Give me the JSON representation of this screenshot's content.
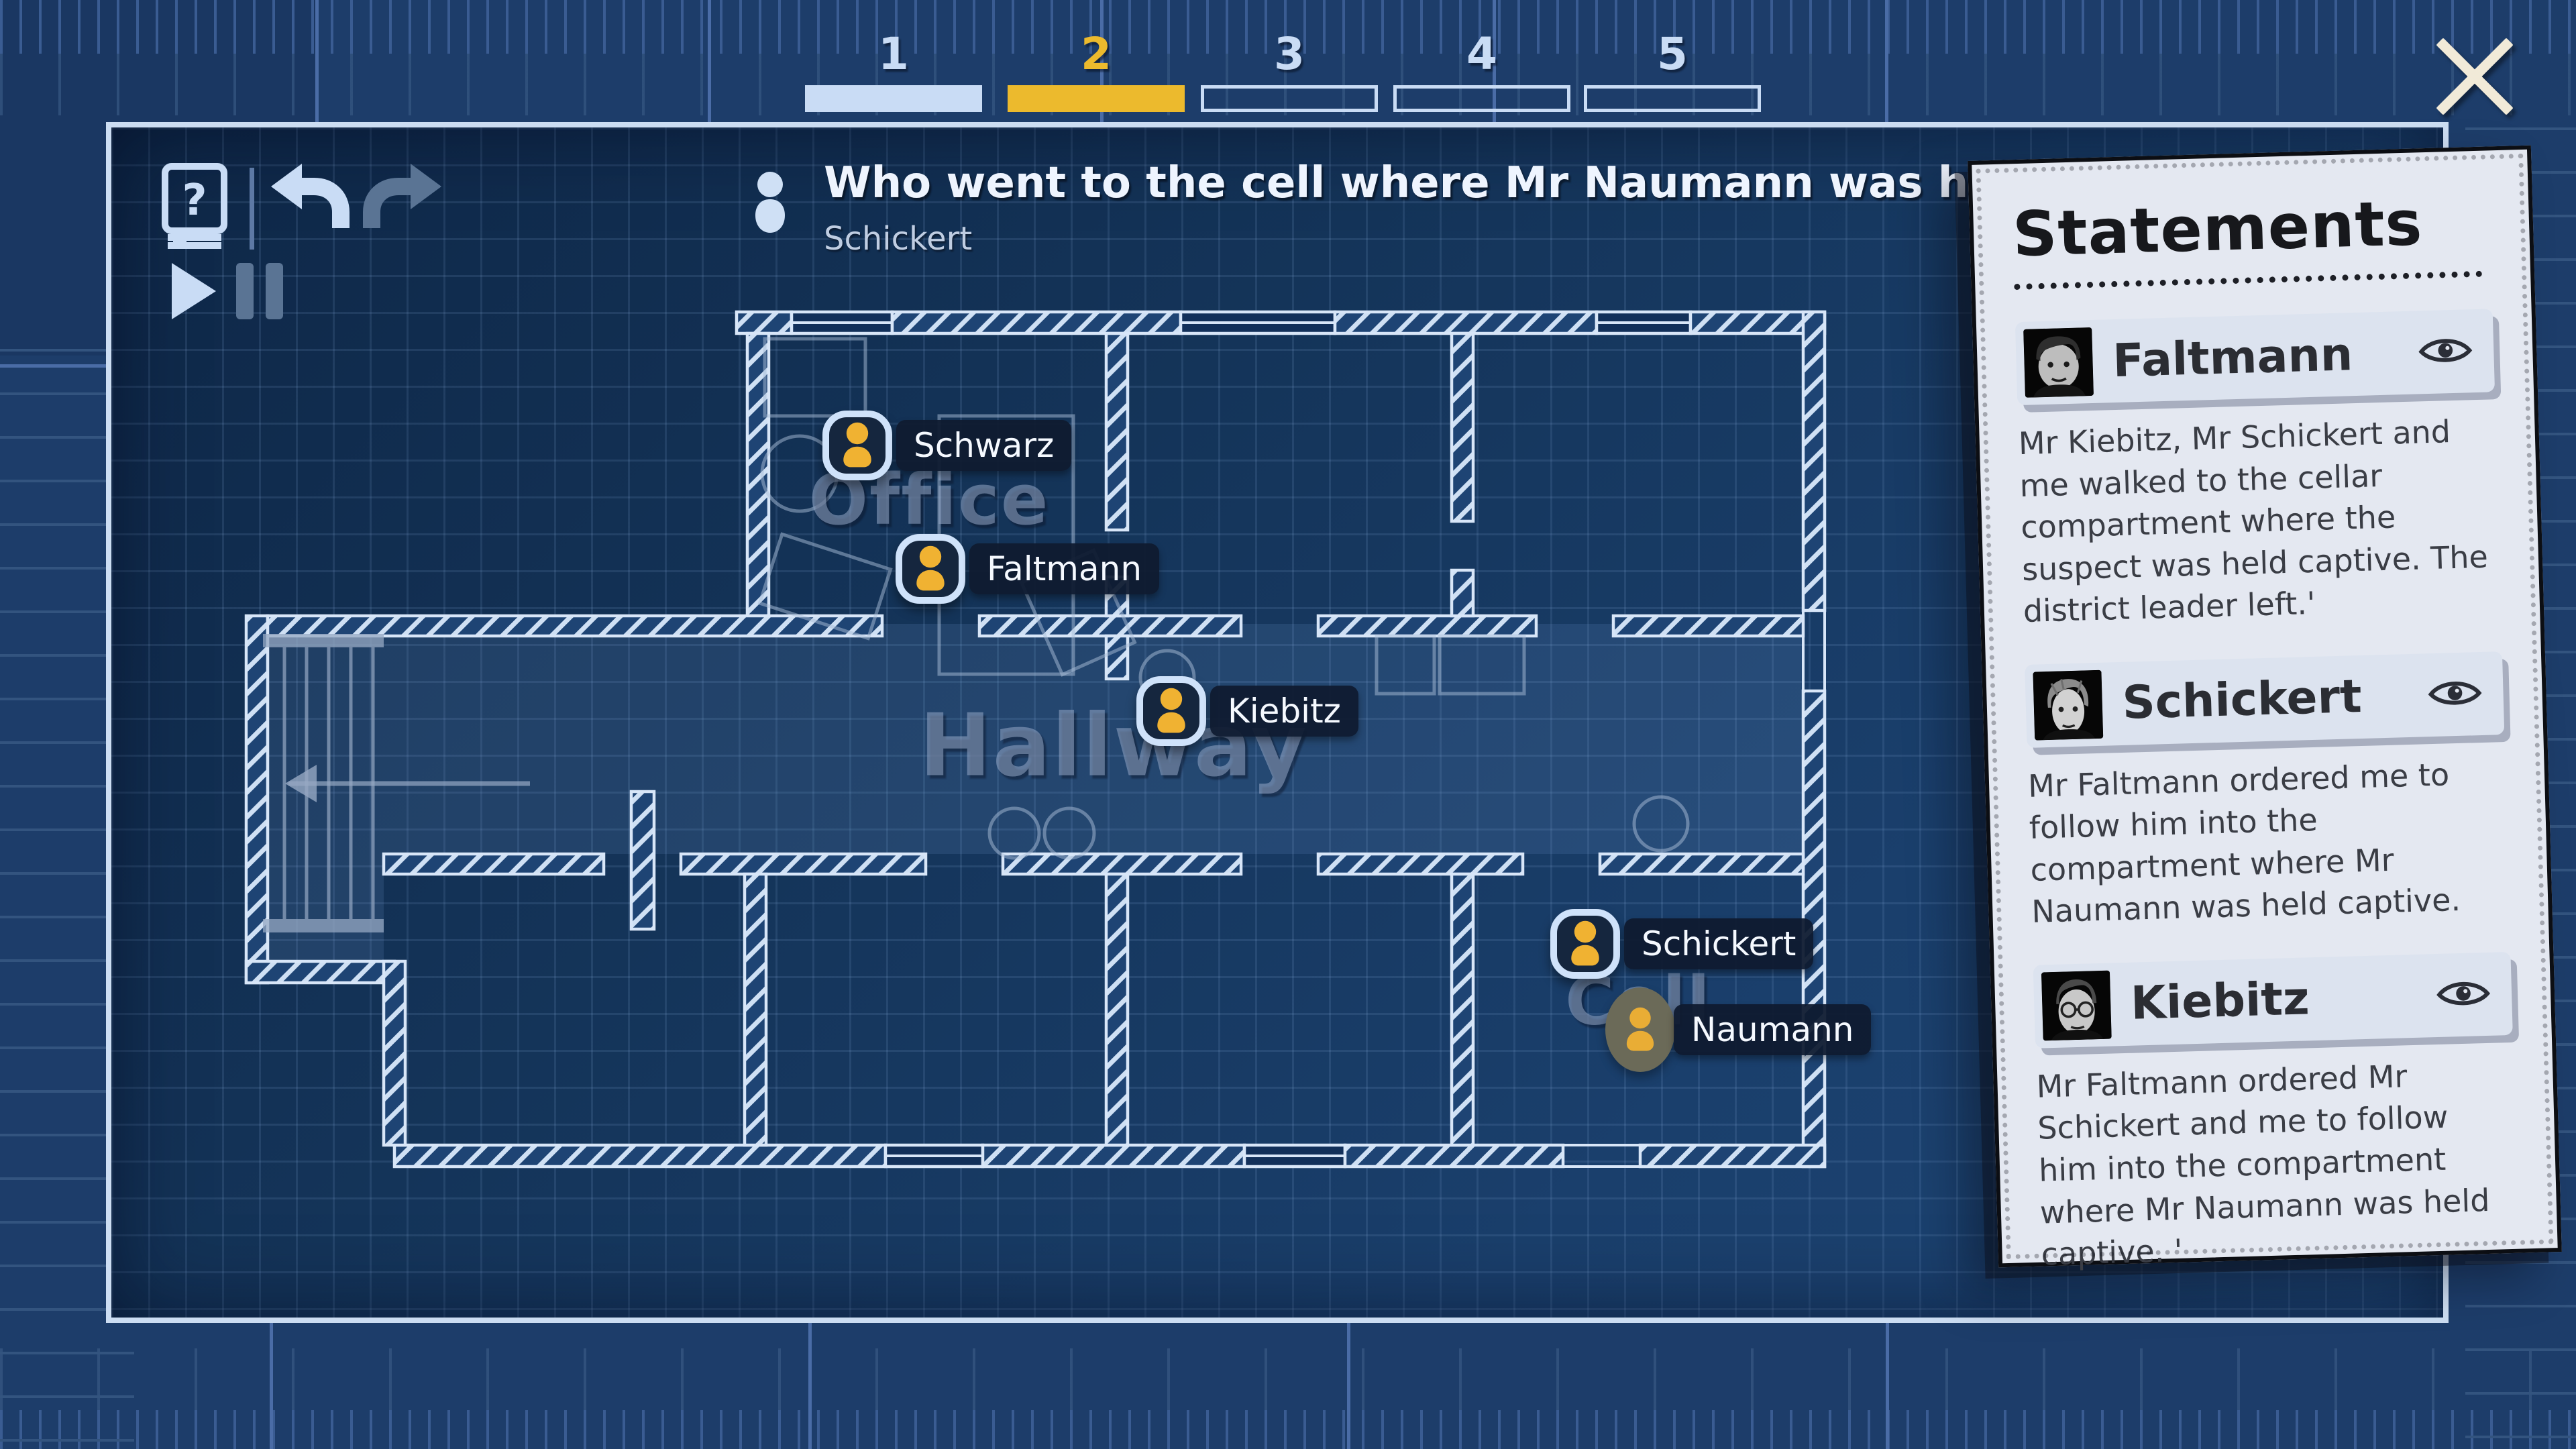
{
  "colors": {
    "bg-out": "#1d3d6a",
    "bg-map": "#133157",
    "bp-light": "#c9dcf5",
    "accent": "#ecba2d",
    "token-amber": "#f0b232",
    "paper": "#e4e8f1",
    "card": "#dce3ef",
    "ink": "#2b2d33",
    "dim-icon": "#5a7494"
  },
  "hud": {
    "toolbar": {
      "icons": [
        "help-book-icon",
        "undo-icon",
        "redo-icon",
        "play-icon",
        "pause-icon"
      ],
      "undo_enabled": true,
      "redo_enabled": false,
      "play_enabled": true,
      "pause_enabled": false
    },
    "progress": {
      "steps": [
        {
          "label": "1",
          "state": "done"
        },
        {
          "label": "2",
          "state": "active"
        },
        {
          "label": "3",
          "state": "todo"
        },
        {
          "label": "4",
          "state": "todo"
        },
        {
          "label": "5",
          "state": "todo"
        }
      ]
    },
    "question": {
      "icon": "person-icon",
      "text": "Who went to the cell where Mr Naumann was held captive?",
      "answer": "Schickert"
    },
    "close": "close-icon"
  },
  "map": {
    "rooms": [
      {
        "name": "Office"
      },
      {
        "name": "Hallway"
      },
      {
        "name": "Cell"
      }
    ],
    "tokens": [
      {
        "name": "Schwarz",
        "type": "suspect",
        "room": "Office"
      },
      {
        "name": "Faltmann",
        "type": "suspect",
        "room": "Office"
      },
      {
        "name": "Kiebitz",
        "type": "suspect",
        "room": "Hallway"
      },
      {
        "name": "Schickert",
        "type": "suspect",
        "room": "Cell"
      },
      {
        "name": "Naumann",
        "type": "victim",
        "room": "Cell"
      }
    ]
  },
  "statements": {
    "title": "Statements",
    "items": [
      {
        "name": "Faltmann",
        "icon": "eye-icon",
        "text": "Mr Kiebitz, Mr Schickert and me walked to the cellar compartment where the suspect was held captive. The district leader left.'"
      },
      {
        "name": "Schickert",
        "icon": "eye-icon",
        "text": "Mr Faltmann ordered me to follow him into the compartment where Mr Naumann was held captive."
      },
      {
        "name": "Kiebitz",
        "icon": "eye-icon",
        "text": "Mr Faltmann ordered Mr Schickert and me to follow him into the compartment where Mr Naumann was held captive. '"
      }
    ]
  }
}
